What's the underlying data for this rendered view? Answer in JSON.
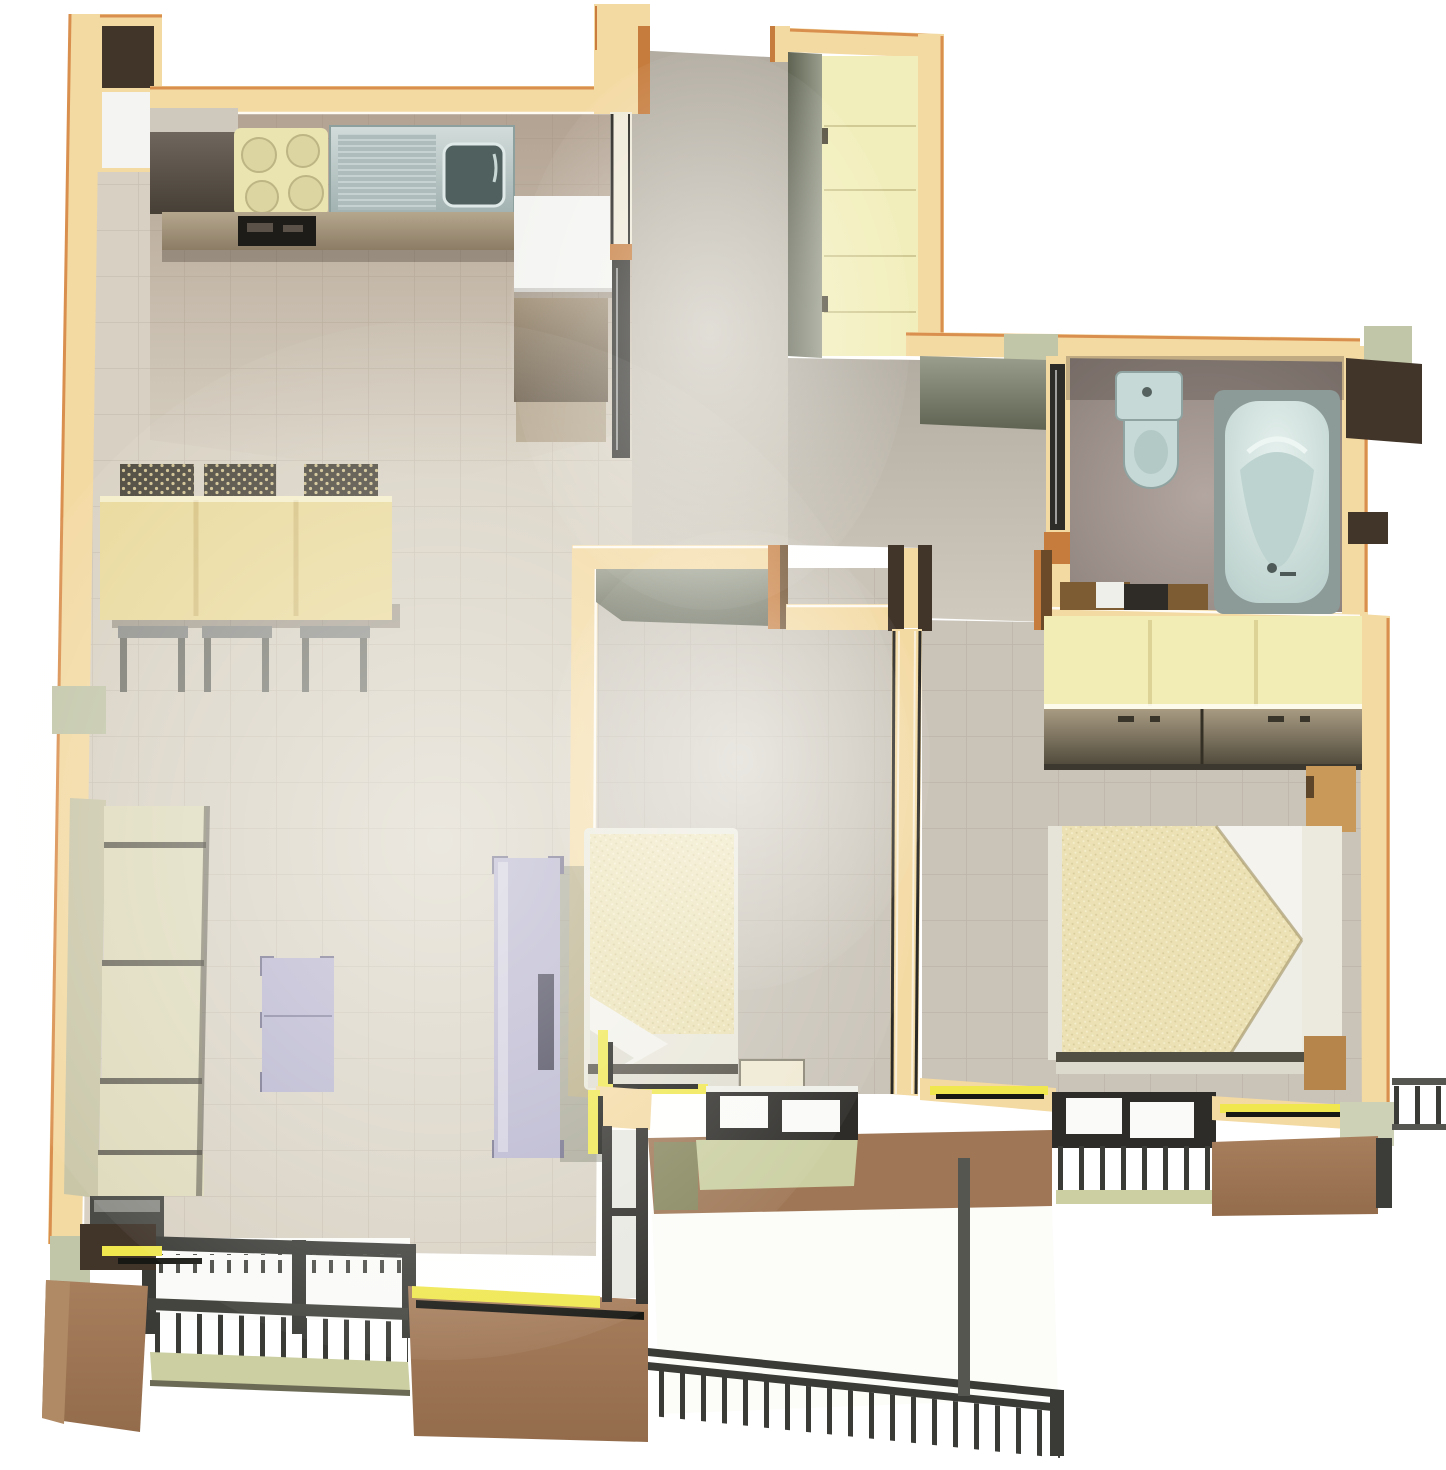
{
  "scene": {
    "type": "3d-rendered-apartment-floor-plan-top-view",
    "rooms": [
      {
        "name": "kitchen",
        "furniture": [
          "tall-dark-cabinet",
          "stove-four-burners",
          "oven",
          "double-sink-with-drainboard",
          "counter-run",
          "white-counter-unit",
          "fridge-niche"
        ]
      },
      {
        "name": "living-dining-room",
        "furniture": [
          "dining-table",
          "three-slat-chairs",
          "three-stools",
          "sectional-sofa",
          "dark-side-table",
          "coffee-table",
          "tv-cabinet",
          "balcony-door",
          "french-window-with-railing"
        ]
      },
      {
        "name": "entry-hall",
        "furniture": [
          "front-door-open",
          "built-in-yellow-closet"
        ]
      },
      {
        "name": "inner-hall",
        "furniture": []
      },
      {
        "name": "bathroom",
        "furniture": [
          "toilet",
          "bathtub",
          "vanity-with-sink",
          "open-door"
        ]
      },
      {
        "name": "small-bedroom",
        "furniture": [
          "single-bed",
          "dresser",
          "window-to-balcony"
        ]
      },
      {
        "name": "master-bedroom",
        "furniture": [
          "double-bed",
          "wardrobe",
          "nightstand",
          "window-with-railing"
        ]
      },
      {
        "name": "balcony",
        "furniture": [
          "white-terrace-floor",
          "metal-railing"
        ]
      }
    ]
  },
  "colors": {
    "background": "#ffffff",
    "wallCream": "#f3d9a2",
    "wallCreamLight": "#fdeabc",
    "wallOrange": "#d98f4e",
    "wallInnerFace": "#848878",
    "wallInnerFaceDark": "#646853",
    "floorMain": "#d8d1c3",
    "floorHall": "#c4beb3",
    "floorBedroom": "#c9c3b8",
    "floorBathLight": "#b1a49e",
    "floorBathDark": "#8d817c",
    "darkWalnut": "#41352a",
    "counterTan": "#9c8b74",
    "counterTanLight": "#b4a58d",
    "counterDark": "#6b6156",
    "cabinetWhite": "#f4f5f2",
    "stoveTop": "#e9e4b0",
    "burner": "#dcd5a2",
    "sinkSteel": "#b6c4c3",
    "sinkBasin": "#4f605e",
    "tableWood": "#e9d99b",
    "chairDark": "#4b463b",
    "stoolMetal": "#8e8e8b",
    "sofaCream": "#dedabc",
    "sofaBack": "#c9c6a8",
    "sofaGap": "#6b675b",
    "lavender": "#b5b2cd",
    "lavenderDark": "#6f6c88",
    "blanket": "#ebe1b5",
    "sheetWhite": "#f2f1eb",
    "bedFootDark": "#514e44",
    "nightstandWood": "#c9995a",
    "dresserPale": "#efe9d2",
    "wardrobeTop": "#f2ecb5",
    "toiletBlue": "#c6d9d6",
    "tubShell": "#8c9a98",
    "tubInner": "#cbdeda",
    "vanityBrown": "#7d5c33",
    "balconyBrown": "#9f7756",
    "balconyBrownLight": "#b08a65",
    "balconyFloor": "#fcfcf9",
    "balconyGreen": "#cbcfa1",
    "railDark": "#3a3a37",
    "stripeYellow": "#efe74d",
    "stripeBlack": "#171714",
    "closetYellow": "#f2eebb",
    "olivePier": "#c2c6a8",
    "doorCopper": "#c67c3d",
    "doorLeaf": "#2d2c29",
    "glassWhite": "#fafaf8"
  }
}
